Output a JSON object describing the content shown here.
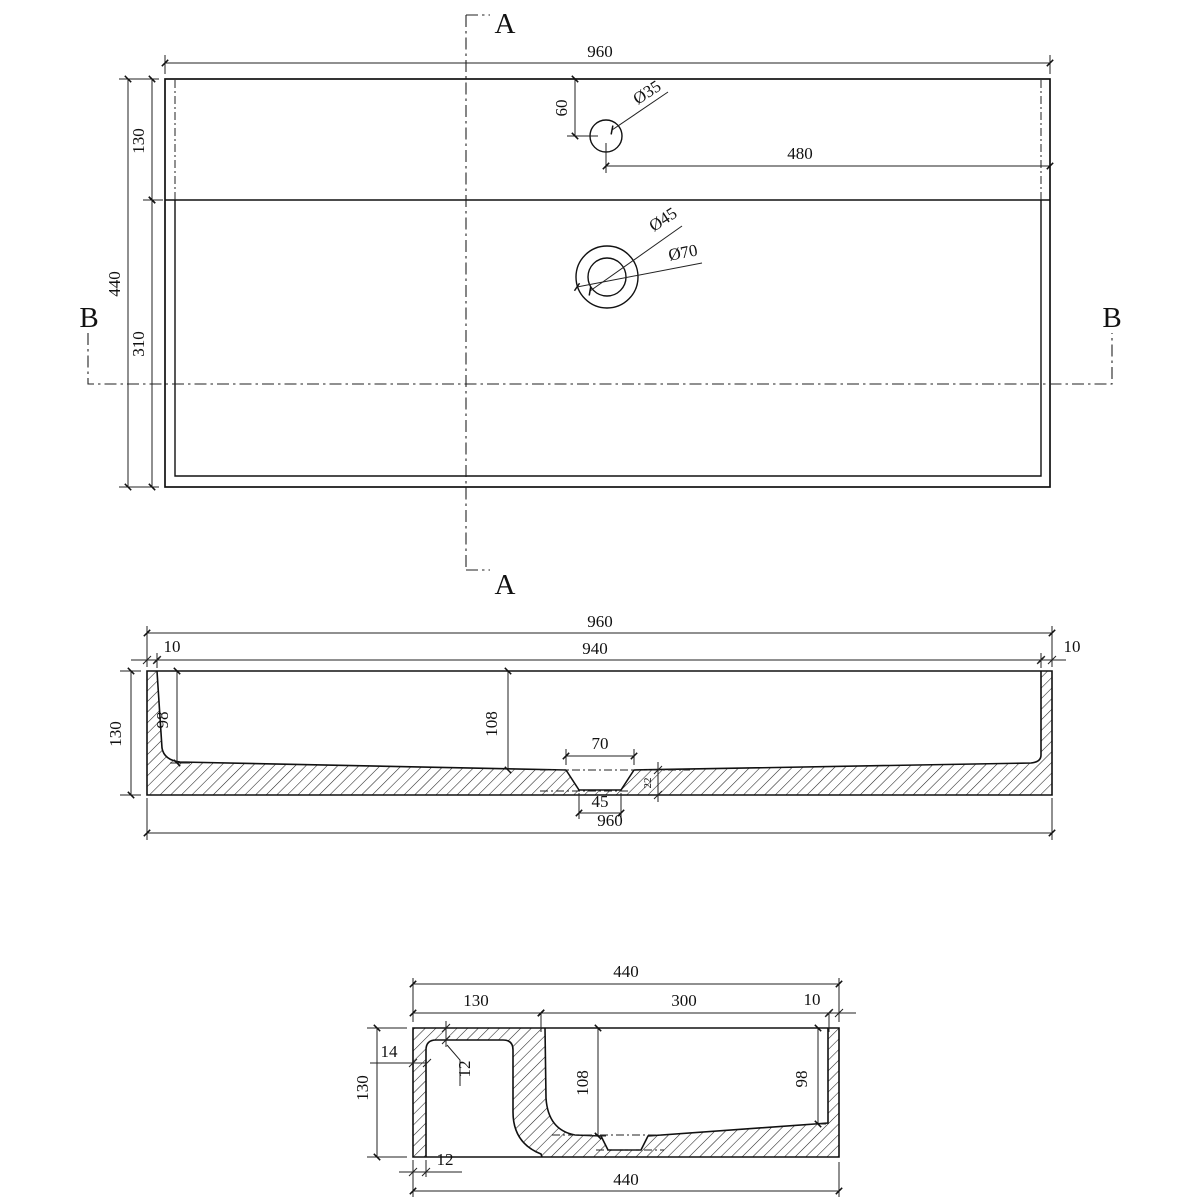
{
  "views": {
    "plan": {
      "overall_width": "960",
      "overall_depth": "440",
      "deck_depth": "130",
      "basin_depth": "310",
      "faucet_from_top": "60",
      "faucet_from_right": "480",
      "faucet_dia": "Ø35",
      "drain_inner_dia": "Ø45",
      "drain_outer_dia": "Ø70",
      "section_a": "A",
      "section_b": "B"
    },
    "front": {
      "overall_width": "960",
      "inner_width": "940",
      "left_wall": "10",
      "right_wall": "10",
      "height": "130",
      "left_depth": "98",
      "center_depth": "108",
      "drain_top": "70",
      "drain_bottom": "45",
      "drain_step": "22",
      "bottom_width": "960"
    },
    "side": {
      "overall_width": "440",
      "deck_width": "130",
      "basin_width": "300",
      "right_wall": "10",
      "height": "130",
      "left_wall": "14",
      "deck_thickness": "12",
      "center_depth": "108",
      "right_depth": "98",
      "base_thickness": "12",
      "bottom_width": "440"
    }
  }
}
